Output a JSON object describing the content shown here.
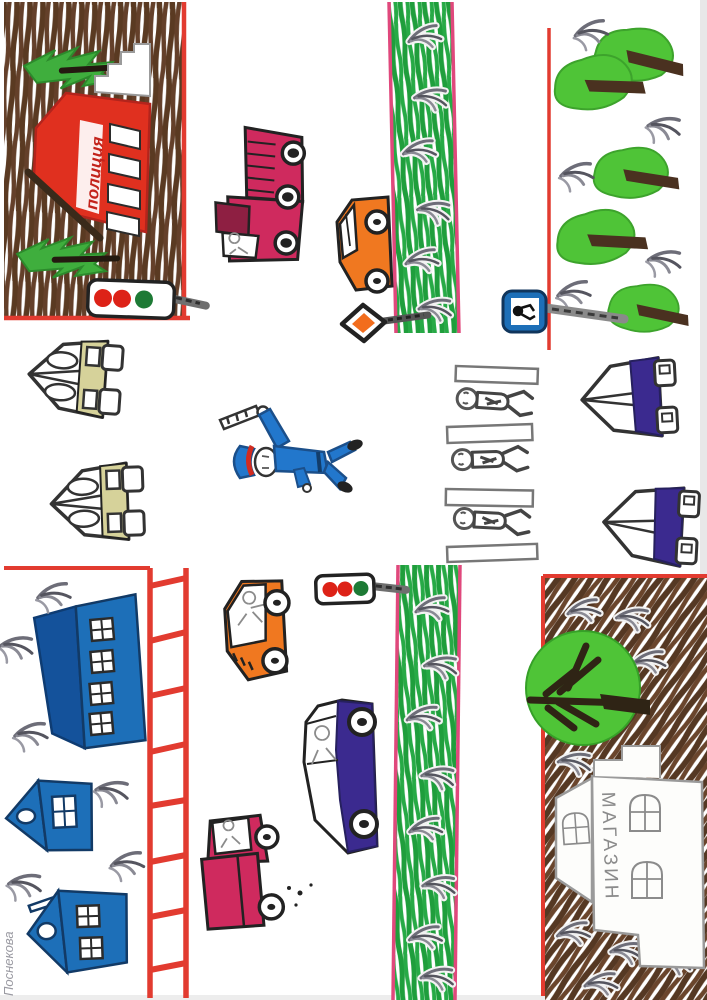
{
  "artwork": {
    "kind": "child's felt-tip marker drawing",
    "subject": "street intersection with traffic policeman, cars, buildings and trees",
    "orientation": "drawn in landscape, scanned rotated 90 degrees"
  },
  "labels": {
    "police_station": "полиция",
    "shop": "МАГАЗИН",
    "signature": "Поснекова"
  },
  "palette": {
    "paper": "#ffffff",
    "border_red": "#e23b30",
    "border_pink": "#e0487c",
    "ground_brown": "#5a3a22",
    "grass_green": "#1f9e3c",
    "tree_green": "#4fc437",
    "fir_green": "#3fae3d",
    "police_red": "#e0301f",
    "house_blue": "#1d6fb8",
    "roof_blue": "#14529b",
    "uniform_blue": "#2277cc",
    "car_crimson": "#cf2a5e",
    "car_crimson_dark": "#8e1f42",
    "car_orange": "#f07820",
    "car_purple": "#3b2a8f",
    "car_olive": "#d6d29a",
    "sign_blue": "#1d6fb8",
    "light_red": "#dd2217",
    "light_green": "#1d7a35",
    "pencil_grey": "#8b8b8b"
  },
  "scene": {
    "blocks": [
      {
        "id": "top-left",
        "ground": "brown scribble",
        "contains": [
          "police station (red)",
          "2 fir trees",
          "traffic light"
        ]
      },
      {
        "id": "top-right",
        "ground": "white park",
        "contains": [
          "5 round green trees",
          "bird/plant sprigs"
        ]
      },
      {
        "id": "bottom-left",
        "ground": "white",
        "contains": [
          "blue apartment block",
          "2 blue houses",
          "red ladder crosswalk",
          "signature"
        ]
      },
      {
        "id": "bottom-right",
        "ground": "brown scribble",
        "contains": [
          "big green tree",
          "shop building (МАГАЗИН)",
          "bird/plant sprigs"
        ]
      }
    ],
    "vehicles": [
      {
        "type": "truck",
        "color": "crimson",
        "road": "top"
      },
      {
        "type": "car",
        "color": "orange",
        "road": "top"
      },
      {
        "type": "car",
        "color": "olive",
        "road": "left"
      },
      {
        "type": "car",
        "color": "olive",
        "road": "left"
      },
      {
        "type": "car",
        "color": "purple",
        "road": "right"
      },
      {
        "type": "car",
        "color": "purple",
        "road": "right"
      },
      {
        "type": "car",
        "color": "orange",
        "road": "bottom"
      },
      {
        "type": "car",
        "color": "purple",
        "road": "bottom"
      },
      {
        "type": "truck",
        "color": "crimson",
        "road": "bottom"
      }
    ],
    "figures": {
      "traffic_policeman": 1,
      "pedestrians": 3
    },
    "traffic_lights": [
      {
        "location": "top-left block",
        "lights": [
          "red",
          "red",
          "green"
        ]
      },
      {
        "location": "bottom median",
        "lights": [
          "red",
          "red",
          "green"
        ]
      }
    ],
    "signs": [
      {
        "name": "main-road diamond sign",
        "colors": [
          "black outline",
          "orange center"
        ]
      },
      {
        "name": "pedestrian-crossing sign",
        "colors": [
          "blue",
          "white",
          "black figure"
        ]
      }
    ],
    "crosswalks": [
      {
        "style": "red ladder",
        "location": "left road",
        "rungs": 8
      },
      {
        "style": "outlined zebra stripes",
        "location": "right road",
        "stripes": 4
      }
    ],
    "median_strips": 2,
    "trees": {
      "fir": 2,
      "round": 5,
      "big_round": 1
    }
  }
}
